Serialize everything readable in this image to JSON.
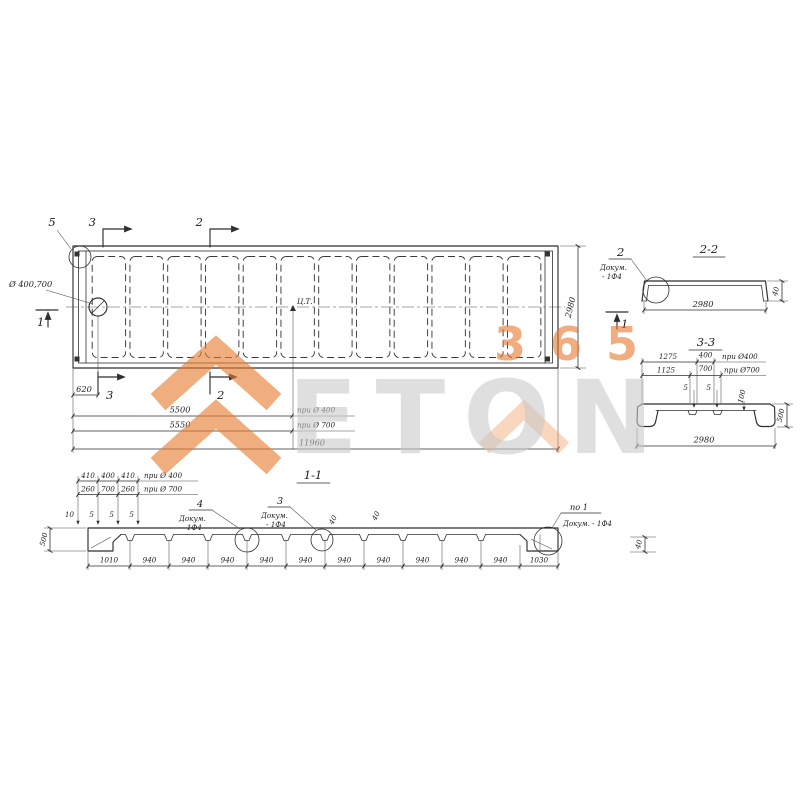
{
  "colors": {
    "accent": "#E87B2C",
    "watermark_digits": "#E8772B",
    "watermark_letters": "#C9C9C9",
    "line": "#2F2F2F"
  },
  "watermark": {
    "digits": "365",
    "brand": "ETON"
  },
  "plan": {
    "hole_label": "Ø 400,700",
    "centroid_label": "Ц.Т.",
    "callout_5": "5",
    "section_3_top": "3",
    "section_2_top": "2",
    "section_3_bottom": "3",
    "section_2_bottom": "2",
    "section_1_left": "1",
    "section_1_right": "1",
    "dim_620": "620",
    "dim_5500": "5500",
    "dim_5550": "5550",
    "dim_11960": "11960",
    "dim_2980": "2980",
    "note_d400": "при Ø 400",
    "note_d700": "при Ø 700"
  },
  "section22": {
    "title": "2-2",
    "callout_num": "2",
    "doc_line1": "Докум.",
    "doc_line2": "- 1Ф4",
    "dim_width": "2980",
    "dim_edge": "40"
  },
  "section33": {
    "title": "3-3",
    "dim_1275": "1275",
    "dim_400": "400",
    "note_d400": "при Ø400",
    "dim_1125": "1125",
    "dim_700": "700",
    "note_d700": "при Ø700",
    "dim_5_left": "5",
    "dim_5_right": "5",
    "dim_100": "100",
    "dim_500": "500",
    "dim_width": "2980"
  },
  "section11": {
    "title": "1-1",
    "dim_410_a": "410",
    "dim_400": "400",
    "dim_410_b": "410",
    "note_d400": "при Ø 400",
    "dim_260_a": "260",
    "dim_700": "700",
    "dim_260_b": "260",
    "note_d700": "при Ø 700",
    "dim_10": "10",
    "dim_5_a": "5",
    "dim_5_b": "5",
    "dim_5_c": "5",
    "dim_500": "500",
    "callout_4": "4",
    "callout_4_doc1": "Докум.",
    "callout_4_doc2": "- 1Ф4",
    "callout_3": "3",
    "callout_3_doc1": "Докум.",
    "callout_3_doc2": "- 1Ф4",
    "callout_po1": "по 1",
    "callout_po1_doc": "Докум. - 1Ф4",
    "mark_40_a": "40",
    "mark_40_b": "40",
    "dim_edge": "40",
    "bottom_dims": [
      "1010",
      "940",
      "940",
      "940",
      "940",
      "940",
      "940",
      "940",
      "940",
      "940",
      "940",
      "1030"
    ]
  }
}
